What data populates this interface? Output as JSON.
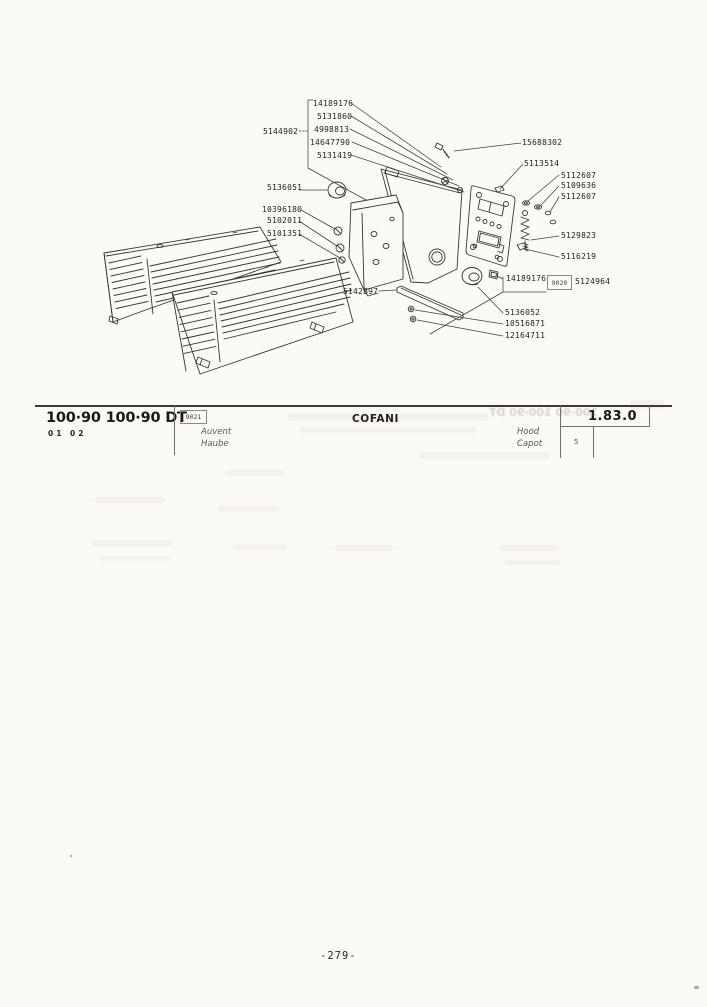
{
  "header": {
    "models": "100·90 100·90 DT",
    "variants": "01 02",
    "code_box": "9021",
    "title_fr": "Auvent",
    "title_de": "Haube",
    "title_it": "COFANI",
    "title_en": "Hood",
    "title_fr2": "Capot",
    "section_code": "1.83.0",
    "sheet": "5"
  },
  "diagram": {
    "ref_box": "9020",
    "labels": [
      {
        "text": "14189176"
      },
      {
        "text": "5131860"
      },
      {
        "text": "4998813"
      },
      {
        "text": "14647790"
      },
      {
        "text": "5131419"
      },
      {
        "text": "5144902"
      },
      {
        "text": "15688302"
      },
      {
        "text": "5113514"
      },
      {
        "text": "5112607"
      },
      {
        "text": "5109636"
      },
      {
        "text": "5112607"
      },
      {
        "text": "5136051"
      },
      {
        "text": "10396180"
      },
      {
        "text": "5102011"
      },
      {
        "text": "5101351"
      },
      {
        "text": "5129823"
      },
      {
        "text": "5116219"
      },
      {
        "text": "14189176"
      },
      {
        "text": "5124964"
      },
      {
        "text": "5142897"
      },
      {
        "text": "5136052"
      },
      {
        "text": "10516871"
      },
      {
        "text": "12164711"
      }
    ]
  },
  "ghost": {
    "header_mirror": "100·90 100·90 DT"
  },
  "footer": {
    "page_number": "-279-"
  }
}
